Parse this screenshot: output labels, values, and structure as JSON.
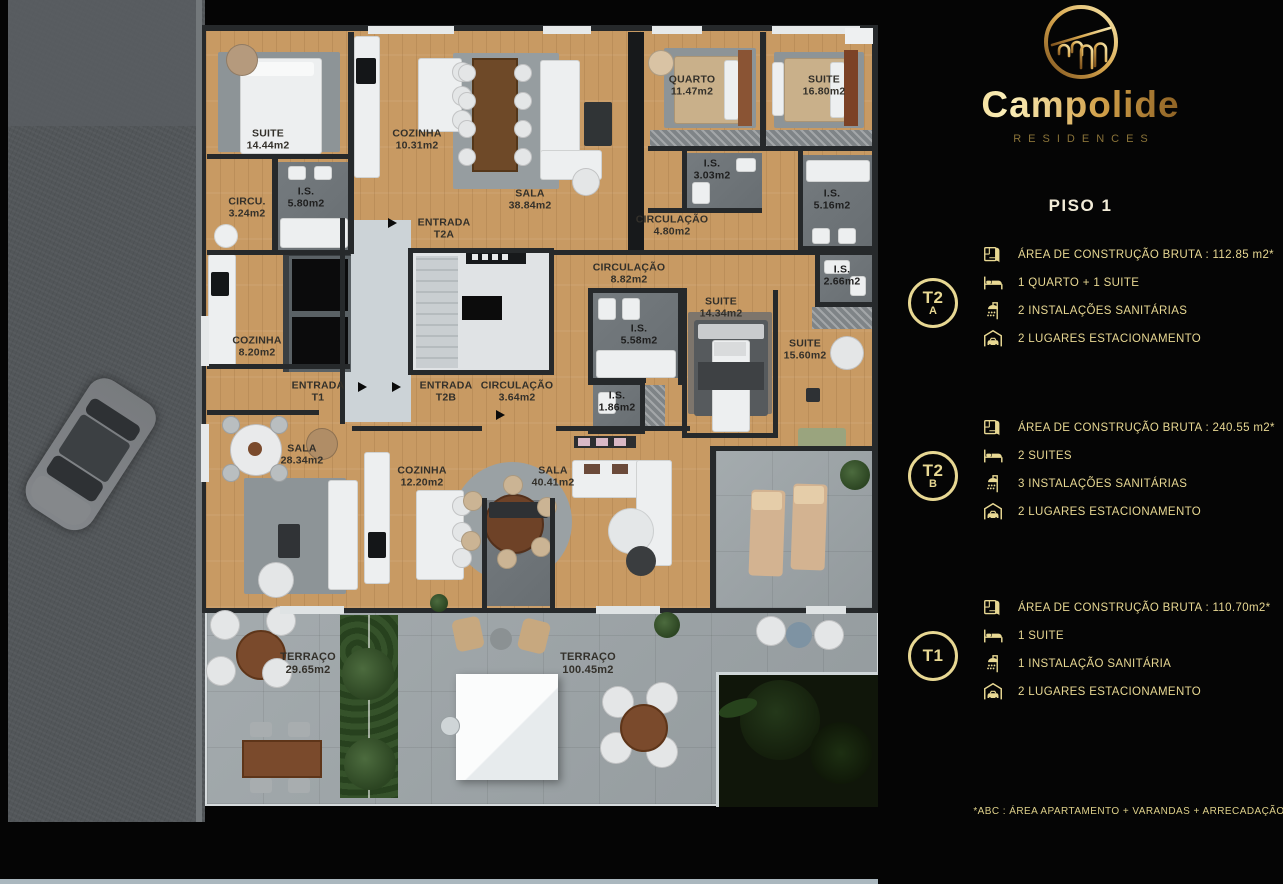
{
  "brand": {
    "name": "Campolide",
    "subtitle": "RESIDENCES",
    "logo_icon": "aqueduct-arches-icon"
  },
  "floor": {
    "title": "PISO 1"
  },
  "units": [
    {
      "badge_top": "T2",
      "badge_bottom": "A",
      "specs": [
        {
          "icon": "floorplan-icon",
          "text": "ÁREA DE CONSTRUÇÃO BRUTA :  112.85 m2*"
        },
        {
          "icon": "bed-icon",
          "text": "1 QUARTO + 1 SUITE"
        },
        {
          "icon": "shower-icon",
          "text": "2 INSTALAÇÕES SANITÁRIAS"
        },
        {
          "icon": "garage-icon",
          "text": "2 LUGARES ESTACIONAMENTO"
        }
      ]
    },
    {
      "badge_top": "T2",
      "badge_bottom": "B",
      "specs": [
        {
          "icon": "floorplan-icon",
          "text": "ÁREA DE CONSTRUÇÃO BRUTA :  240.55 m2*"
        },
        {
          "icon": "bed-icon",
          "text": "2 SUITES"
        },
        {
          "icon": "shower-icon",
          "text": "3 INSTALAÇÕES SANITÁRIAS"
        },
        {
          "icon": "garage-icon",
          "text": "2 LUGARES ESTACIONAMENTO"
        }
      ]
    },
    {
      "badge_top": "T1",
      "badge_bottom": "",
      "specs": [
        {
          "icon": "floorplan-icon",
          "text": "ÁREA DE CONSTRUÇÃO BRUTA :  110.70m2*"
        },
        {
          "icon": "bed-icon",
          "text": "1 SUITE"
        },
        {
          "icon": "shower-icon",
          "text": "1 INSTALAÇÃO SANITÁRIA"
        },
        {
          "icon": "garage-icon",
          "text": "2 LUGARES ESTACIONAMENTO"
        }
      ]
    }
  ],
  "footnote": "*ABC :  ÁREA APARTAMENTO + VARANDAS + ARRECADAÇÃO",
  "plan": {
    "rooms": [
      {
        "name": "SUITE",
        "area": "14.44m2"
      },
      {
        "name": "COZINHA",
        "area": "10.31m2"
      },
      {
        "name": "SALA",
        "area": "38.84m2"
      },
      {
        "name": "QUARTO",
        "area": "11.47m2"
      },
      {
        "name": "SUITE",
        "area": "16.80m2"
      },
      {
        "name": "CIRCU.",
        "area": "3.24m2"
      },
      {
        "name": "I.S.",
        "area": "5.80m2"
      },
      {
        "name": "I.S.",
        "area": "3.03m2"
      },
      {
        "name": "I.S.",
        "area": "5.16m2"
      },
      {
        "name": "ENTRADA",
        "area": "T2A"
      },
      {
        "name": "CIRCULAÇÃO",
        "area": "4.80m2"
      },
      {
        "name": "CIRCULAÇÃO",
        "area": "8.82m2"
      },
      {
        "name": "I.S.",
        "area": "2.66m2"
      },
      {
        "name": "SUITE",
        "area": "14.34m2"
      },
      {
        "name": "COZINHA",
        "area": "8.20m2"
      },
      {
        "name": "I.S.",
        "area": "5.58m2"
      },
      {
        "name": "SUITE",
        "area": "15.60m2"
      },
      {
        "name": "ENTRADA",
        "area": "T1"
      },
      {
        "name": "ENTRADA",
        "area": "T2B"
      },
      {
        "name": "CIRCULAÇÃO",
        "area": "3.64m2"
      },
      {
        "name": "I.S.",
        "area": "1.86m2"
      },
      {
        "name": "SALA",
        "area": "28.34m2"
      },
      {
        "name": "COZINHA",
        "area": "12.20m2"
      },
      {
        "name": "SALA",
        "area": "40.41m2"
      },
      {
        "name": "TERRAÇO",
        "area": "29.65m2"
      },
      {
        "name": "TERRAÇO",
        "area": "100.45m2"
      }
    ]
  },
  "colors": {
    "gold": "#e8d893",
    "panel_bg": "#050505",
    "wood": "#c89a63",
    "concrete": "#9ba2a5",
    "wall": "#26292b"
  }
}
